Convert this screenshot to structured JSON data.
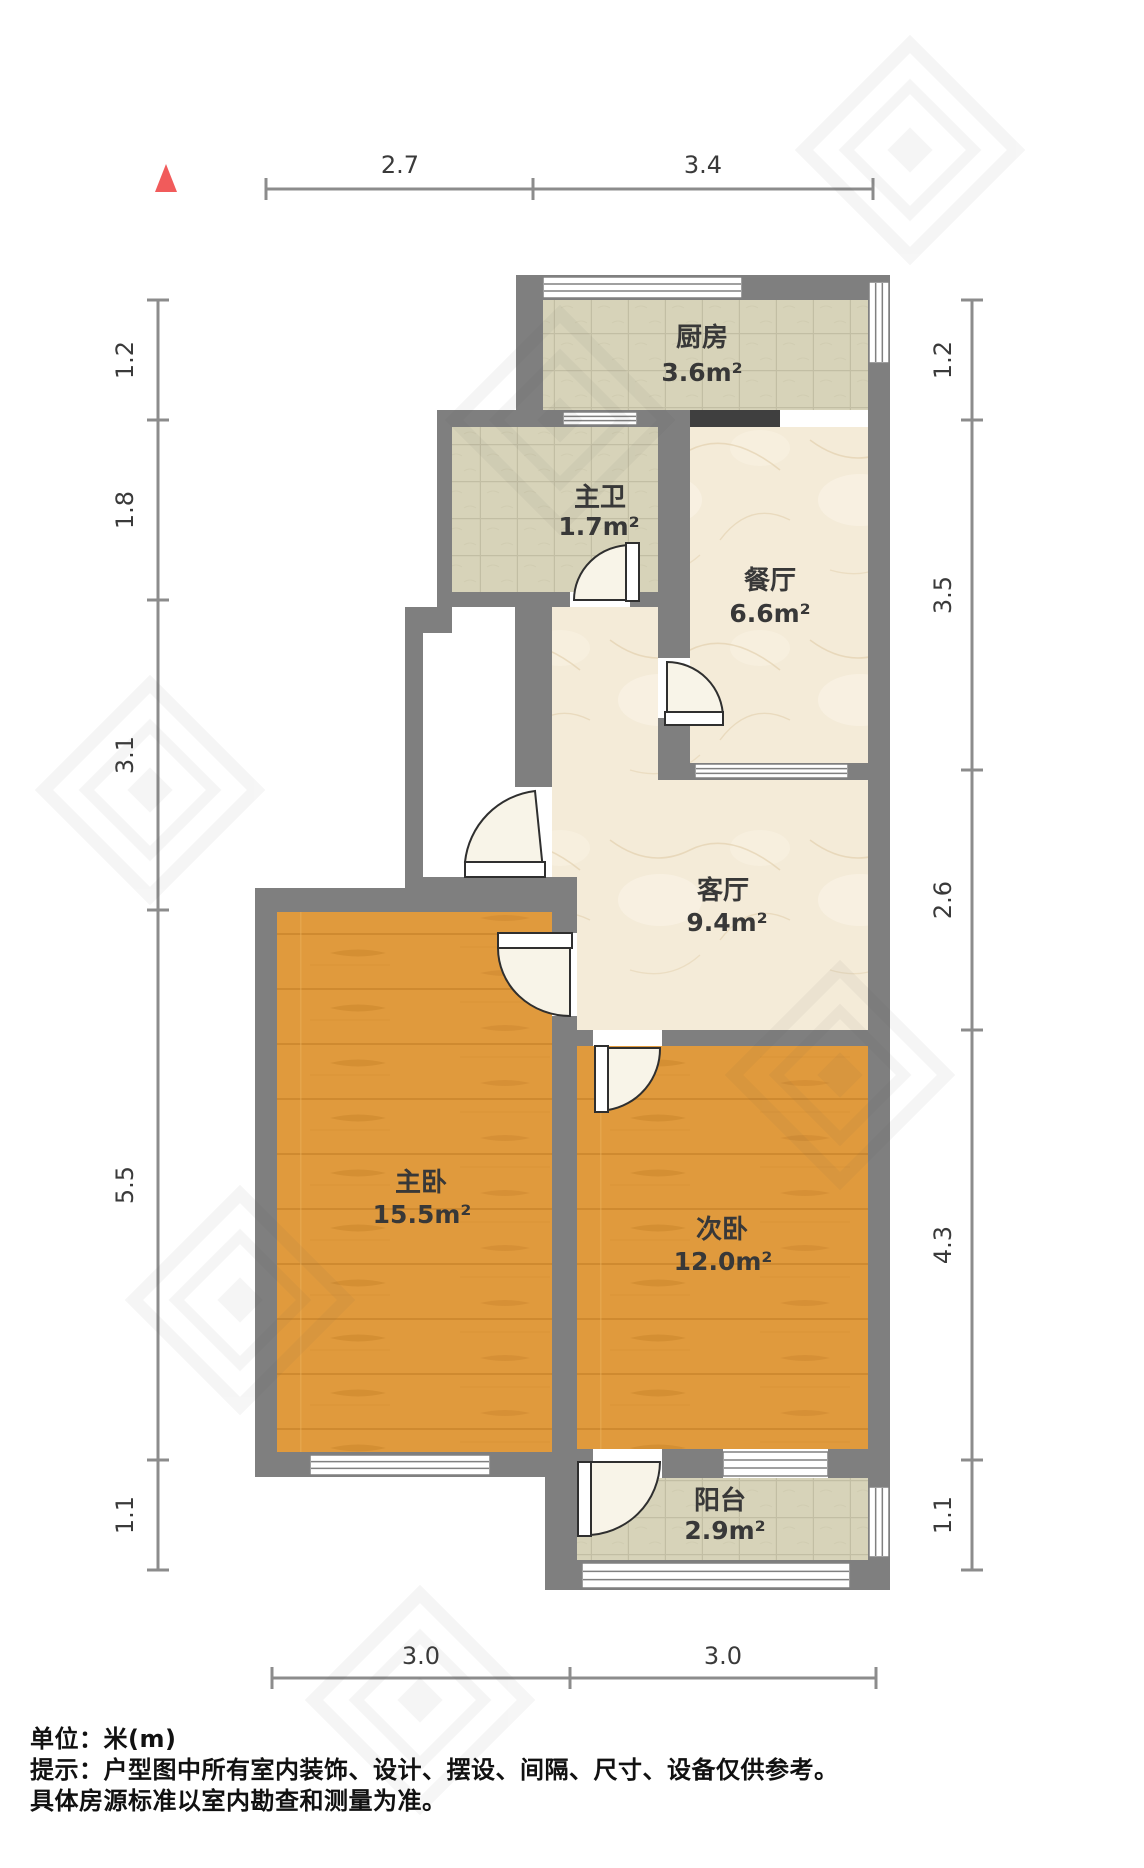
{
  "meta": {
    "unit_label": "单位：米(m)",
    "note_line1": "提示：户型图中所有室内装饰、设计、摆设、间隔、尺寸、设备仅供参考。",
    "note_line2": "具体房源标准以室内勘查和测量为准。"
  },
  "colors": {
    "wall": "#7f7f7f",
    "dark_opening": "#3f3f3f",
    "tile_base": "#d7d3b9",
    "tile_line": "#b7b399",
    "marble_base": "#f4ebd8",
    "marble_vein": "#dcc69e",
    "wood_base": "#e09a3d",
    "wood_grain": "#c8832a",
    "door_wedge": "#f8f4e8",
    "door_stroke": "#2f2f2f",
    "window_stroke": "#808080",
    "dim_line": "#8c8c8c",
    "dim_text": "#3a3a3a",
    "label_text": "#383838",
    "compass_red": "#f15b5b"
  },
  "compass": {
    "points": "166,164 155,192 177,192"
  },
  "rooms": [
    {
      "id": "kitchen",
      "name": "厨房",
      "area": "3.6m²",
      "floor": "tile",
      "rect": [
        543,
        300,
        325,
        110
      ],
      "name_pos": [
        702,
        346
      ],
      "area_pos": [
        702,
        381
      ]
    },
    {
      "id": "master-bath",
      "name": "主卫",
      "area": "1.7m²",
      "floor": "tile",
      "rect": [
        452,
        425,
        206,
        167
      ],
      "name_pos": [
        600,
        506
      ],
      "area_pos": [
        599,
        535
      ]
    },
    {
      "id": "dining",
      "name": "餐厅",
      "area": "6.6m²",
      "floor": "marble",
      "rect": [
        690,
        427,
        178,
        336
      ],
      "name_pos": [
        770,
        589
      ],
      "area_pos": [
        770,
        622
      ]
    },
    {
      "id": "living",
      "name": "客厅",
      "area": "9.4m²",
      "floor": "marble",
      "path": "M552,607 L658,607 L658,780 L868,780 L868,1030 L577,1030 L577,877 L552,877 Z",
      "name_pos": [
        723,
        899
      ],
      "area_pos": [
        727,
        931
      ]
    },
    {
      "id": "master-bedroom",
      "name": "主卧",
      "area": "15.5m²",
      "floor": "wood",
      "rect": [
        277,
        912,
        275,
        540
      ],
      "name_pos": [
        421,
        1191
      ],
      "area_pos": [
        422,
        1223
      ]
    },
    {
      "id": "second-bedroom",
      "name": "次卧",
      "area": "12.0m²",
      "floor": "wood",
      "rect": [
        577,
        1046,
        291,
        403
      ],
      "name_pos": [
        722,
        1238
      ],
      "area_pos": [
        723,
        1270
      ]
    },
    {
      "id": "balcony",
      "name": "阳台",
      "area": "2.9m²",
      "floor": "tile",
      "rect": [
        577,
        1478,
        291,
        85
      ],
      "name_pos": [
        720,
        1509
      ],
      "area_pos": [
        725,
        1539
      ]
    }
  ],
  "walls": [
    [
      516,
      275,
      374,
      25
    ],
    [
      516,
      275,
      27,
      137
    ],
    [
      868,
      275,
      22,
      1315
    ],
    [
      437,
      410,
      253,
      17
    ],
    [
      437,
      412,
      15,
      195
    ],
    [
      658,
      412,
      32,
      246
    ],
    [
      658,
      718,
      32,
      45
    ],
    [
      437,
      592,
      133,
      15
    ],
    [
      630,
      592,
      28,
      15
    ],
    [
      405,
      607,
      47,
      26
    ],
    [
      405,
      617,
      18,
      273
    ],
    [
      515,
      607,
      37,
      180
    ],
    [
      658,
      763,
      210,
      17
    ],
    [
      405,
      877,
      172,
      35
    ],
    [
      255,
      888,
      150,
      24
    ],
    [
      255,
      888,
      22,
      589
    ],
    [
      552,
      877,
      25,
      56
    ],
    [
      552,
      1016,
      25,
      439
    ],
    [
      577,
      1030,
      16,
      16
    ],
    [
      662,
      1030,
      206,
      16
    ],
    [
      255,
      1452,
      322,
      25
    ],
    [
      577,
      1449,
      16,
      29
    ],
    [
      662,
      1449,
      61,
      29
    ],
    [
      828,
      1449,
      40,
      29
    ],
    [
      545,
      1455,
      32,
      135
    ],
    [
      545,
      1560,
      345,
      30
    ]
  ],
  "dark_openings": [
    [
      690,
      410,
      90,
      17
    ]
  ],
  "white_gaps": [
    [
      780,
      410,
      88,
      17
    ],
    [
      423,
      633,
      92,
      154
    ]
  ],
  "windows": [
    {
      "x": 543,
      "y": 277,
      "w": 199,
      "h": 21,
      "o": "h"
    },
    {
      "x": 869,
      "y": 282,
      "w": 20,
      "h": 81,
      "o": "v"
    },
    {
      "x": 563,
      "y": 412,
      "w": 74,
      "h": 13,
      "o": "h"
    },
    {
      "x": 695,
      "y": 764,
      "w": 153,
      "h": 14,
      "o": "h"
    },
    {
      "x": 310,
      "y": 1455,
      "w": 180,
      "h": 20,
      "o": "h"
    },
    {
      "x": 723,
      "y": 1452,
      "w": 105,
      "h": 24,
      "o": "h"
    },
    {
      "x": 869,
      "y": 1487,
      "w": 20,
      "h": 70,
      "o": "v"
    },
    {
      "x": 582,
      "y": 1563,
      "w": 268,
      "h": 25,
      "o": "h"
    }
  ],
  "doors": [
    {
      "id": "bath-door",
      "wedge": "M631,600 L631,545 A57,55 0 0 0 574,600 Z",
      "leaf": [
        626,
        543,
        13,
        58
      ]
    },
    {
      "id": "dining-door",
      "wedge": "M667,718 L667,662 A56,56 0 0 1 723,718 Z",
      "leaf": [
        665,
        712,
        58,
        13
      ]
    },
    {
      "id": "entry-door",
      "wedge": "M543,870 L535,791 A80,80 0 0 0 465,862 Z",
      "leaf": [
        465,
        862,
        80,
        15
      ]
    },
    {
      "id": "master-bedroom-door",
      "wedge": "M570,948 L498,948 A72,68 0 0 0 570,1016 Z",
      "leaf": [
        498,
        933,
        74,
        15
      ]
    },
    {
      "id": "second-bedroom-door",
      "wedge": "M604,1048 L608,1110 A62,62 0 0 0 660,1048 Z",
      "leaf": [
        595,
        1046,
        13,
        66
      ]
    },
    {
      "id": "balcony-door",
      "wedge": "M586,1462 L586,1535 A74,74 0 0 0 660,1462 Z",
      "leaf": [
        578,
        1462,
        13,
        74
      ]
    }
  ],
  "dimensions": {
    "top": {
      "y": 189,
      "from": 266,
      "to": 873,
      "ticks": [
        266,
        533,
        873
      ],
      "label_y": 173,
      "labels": [
        {
          "text": "2.7",
          "x": 400
        },
        {
          "text": "3.4",
          "x": 703
        }
      ]
    },
    "bottom": {
      "y": 1678,
      "from": 272,
      "to": 876,
      "ticks": [
        272,
        570,
        876
      ],
      "label_y": 1664,
      "labels": [
        {
          "text": "3.0",
          "x": 421
        },
        {
          "text": "3.0",
          "x": 723
        }
      ]
    },
    "left": {
      "x": 158,
      "from": 300,
      "to": 1570,
      "ticks": [
        300,
        420,
        600,
        910,
        1460,
        1570
      ],
      "label_x": 133,
      "labels": [
        {
          "text": "1.2",
          "y": 360
        },
        {
          "text": "1.8",
          "y": 510
        },
        {
          "text": "3.1",
          "y": 755
        },
        {
          "text": "5.5",
          "y": 1185
        },
        {
          "text": "1.1",
          "y": 1515
        }
      ]
    },
    "right": {
      "x": 972,
      "from": 300,
      "to": 1570,
      "ticks": [
        300,
        420,
        770,
        1030,
        1460,
        1570
      ],
      "label_x": 951,
      "labels": [
        {
          "text": "1.2",
          "y": 360
        },
        {
          "text": "3.5",
          "y": 595
        },
        {
          "text": "2.6",
          "y": 900
        },
        {
          "text": "4.3",
          "y": 1245
        },
        {
          "text": "1.1",
          "y": 1515
        }
      ]
    }
  },
  "watermarks": [
    [
      560,
      420
    ],
    [
      150,
      790
    ],
    [
      840,
      1075
    ],
    [
      420,
      1700
    ],
    [
      910,
      150
    ],
    [
      240,
      1300
    ]
  ]
}
